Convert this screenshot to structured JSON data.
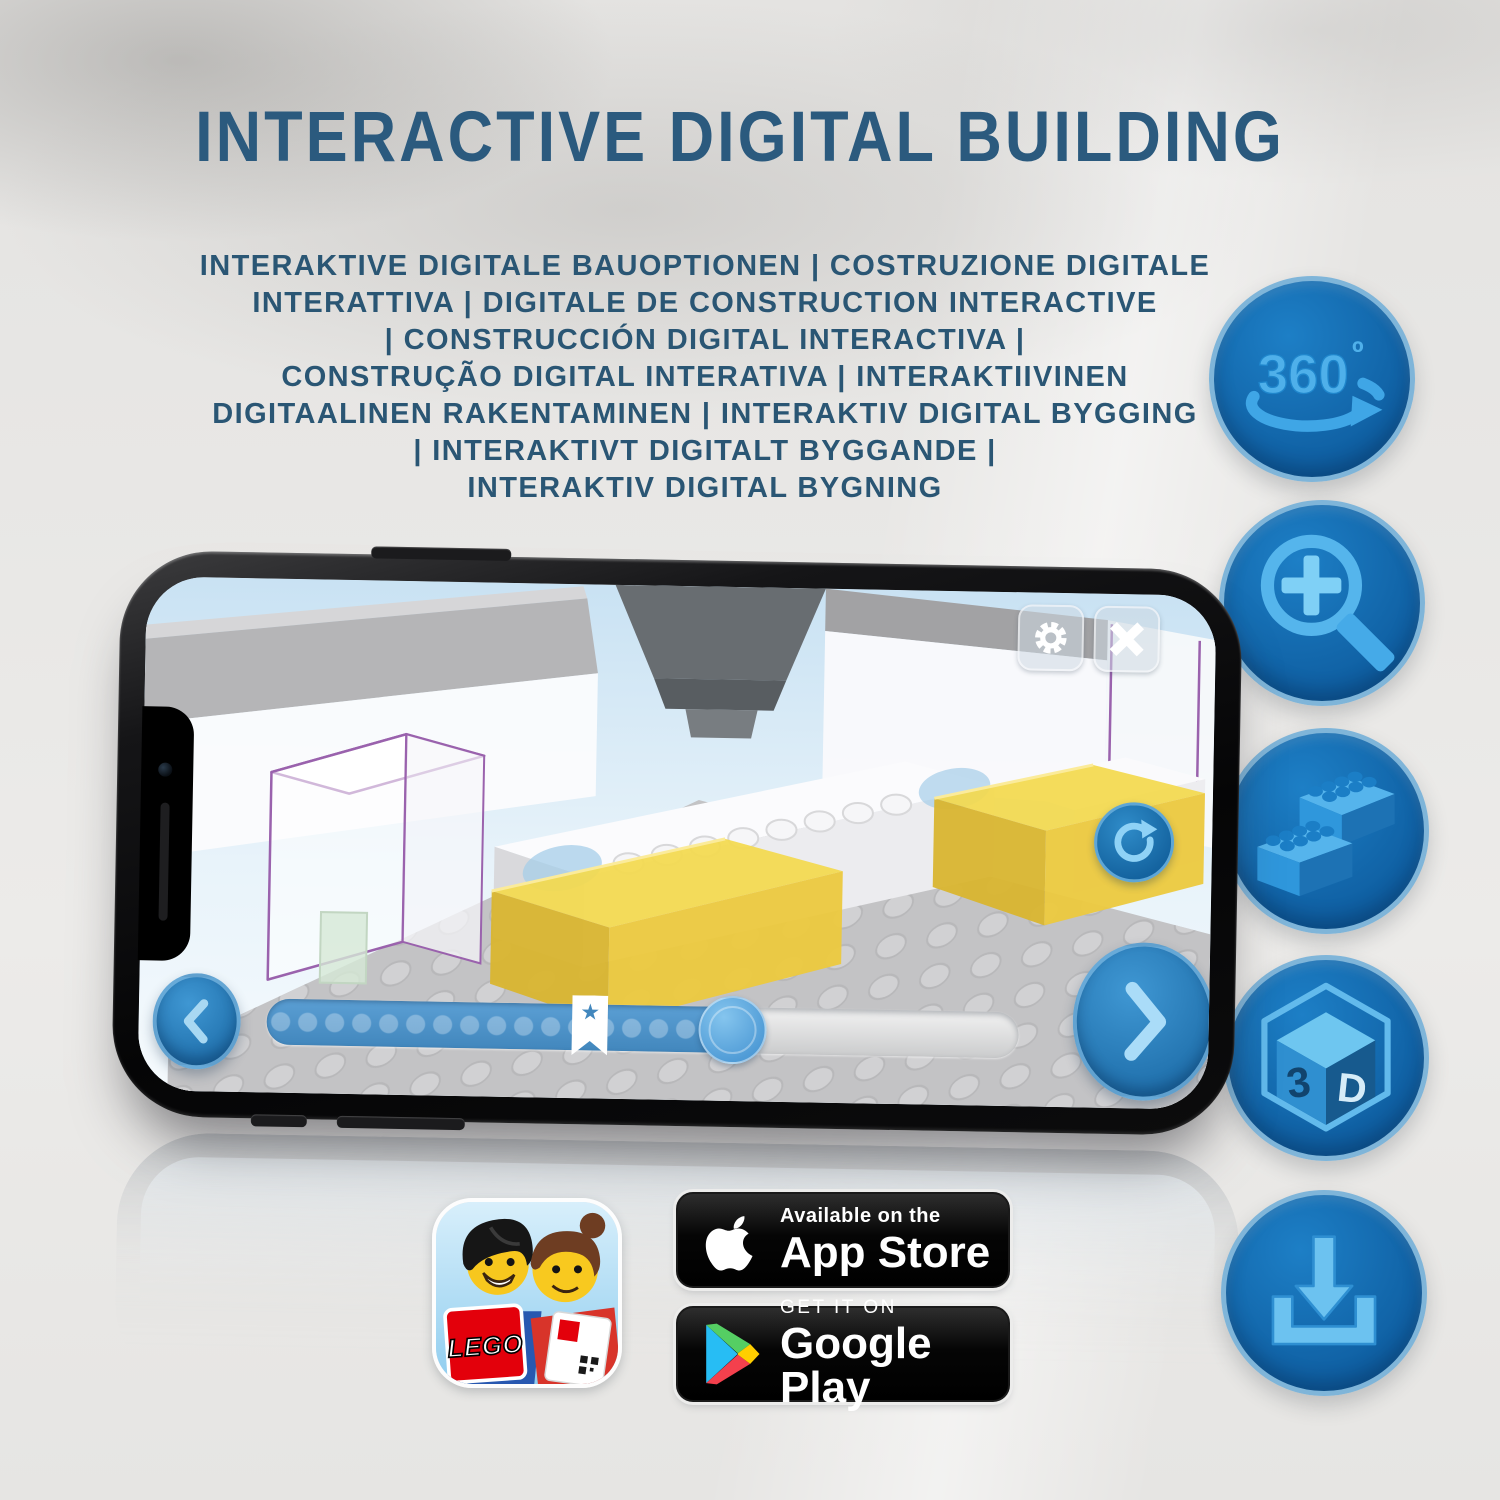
{
  "header": {
    "title": "INTERACTIVE DIGITAL BUILDING",
    "subtitle_lines": [
      "INTERAKTIVE DIGITALE BAUOPTIONEN | COSTRUZIONE DIGITALE",
      "INTERATTIVA | DIGITALE DE CONSTRUCTION INTERACTIVE",
      "| CONSTRUCCIÓN DIGITAL INTERACTIVA |",
      "CONSTRUÇÃO DIGITAL INTERATIVA | INTERAKTIIVINEN",
      "DIGITAALINEN RAKENTAMINEN | INTERAKTIV DIGITAL BYGGING",
      "| INTERAKTIVT DIGITALT BYGGANDE |",
      "INTERAKTIV DIGITAL BYGNING"
    ]
  },
  "feature_icons": [
    {
      "name": "360-rotation",
      "text": "360",
      "degree": "º"
    },
    {
      "name": "zoom-in-magnifier"
    },
    {
      "name": "lego-bricks"
    },
    {
      "name": "3d-cube",
      "left_face": "3",
      "right_face": "D"
    },
    {
      "name": "download"
    }
  ],
  "phone_app": {
    "top_buttons": [
      {
        "name": "settings-gear"
      },
      {
        "name": "close-x"
      }
    ],
    "refresh_button": {
      "name": "refresh-rotate"
    },
    "nav_buttons": {
      "prev": "chevron-left",
      "next": "chevron-right"
    },
    "slider": {
      "progress_percent": 62,
      "bookmark_percent": 43,
      "handle_percent": 62,
      "dot_count": 18,
      "star": "★"
    }
  },
  "badges": {
    "lego_app": {
      "logo": "LEGO"
    },
    "app_store": {
      "tagline": "Available on the",
      "name": "App Store"
    },
    "google_play": {
      "tagline": "GET IT ON",
      "name": "Google Play"
    }
  },
  "colors": {
    "title_blue": "#2b5a7e",
    "feature_circle_blue": "#1470b8",
    "feature_glyph_blue": "#45aae8",
    "progress_blue": "#4287bd",
    "yellow_brick": "#f3d94f",
    "purple_outline": "#9a62ad",
    "badge_black": "#000000",
    "lego_red": "#e3000b"
  }
}
